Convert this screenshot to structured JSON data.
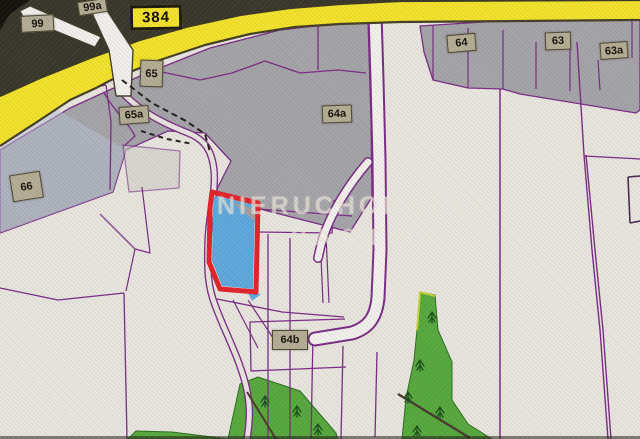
{
  "map": {
    "road_number": "384",
    "watermark": {
      "line1": "NIERUCHOMOŚCI",
      "line2": "PASTWA"
    },
    "highlight": {
      "fill_color": "#5fa8dc",
      "outline_color": "#e3242b"
    },
    "palette": {
      "background": "#e9e6df",
      "built_gray": "#a5a4a9",
      "boundary_purple": "#7b2d85",
      "road_yellow": "#f3e32c",
      "forest_green": "#57a93e",
      "label_tan": "#b5ad95"
    },
    "labels": [
      {
        "text": "99",
        "kind": "parcel",
        "x": 21,
        "y": 15,
        "w": 33,
        "h": 17,
        "rot": -3
      },
      {
        "text": "99a",
        "kind": "parcel",
        "x": 78,
        "y": 0,
        "w": 29,
        "h": 14,
        "rot": -9
      },
      {
        "text": "384",
        "kind": "road",
        "x": 130,
        "y": 5,
        "w": 52,
        "h": 25,
        "rot": -1
      },
      {
        "text": "65",
        "kind": "parcel",
        "x": 140,
        "y": 60,
        "w": 23,
        "h": 27,
        "rot": 2
      },
      {
        "text": "65a",
        "kind": "parcel",
        "x": 119,
        "y": 106,
        "w": 30,
        "h": 18,
        "rot": -4
      },
      {
        "text": "66",
        "kind": "parcel",
        "x": 11,
        "y": 173,
        "w": 31,
        "h": 27,
        "rot": -9
      },
      {
        "text": "64",
        "kind": "parcel",
        "x": 447,
        "y": 34,
        "w": 29,
        "h": 18,
        "rot": -5
      },
      {
        "text": "63",
        "kind": "parcel",
        "x": 545,
        "y": 32,
        "w": 26,
        "h": 18,
        "rot": -2
      },
      {
        "text": "63a",
        "kind": "parcel",
        "x": 600,
        "y": 42,
        "w": 28,
        "h": 17,
        "rot": -4
      },
      {
        "text": "64a",
        "kind": "parcel",
        "x": 322,
        "y": 105,
        "w": 30,
        "h": 18,
        "rot": -2
      },
      {
        "text": "64b",
        "kind": "parcel",
        "x": 272,
        "y": 330,
        "w": 36,
        "h": 20,
        "rot": 0
      }
    ],
    "geometry": {
      "trees": [
        [
          265,
          402
        ],
        [
          297,
          412
        ],
        [
          318,
          430
        ],
        [
          408,
          398
        ],
        [
          417,
          432
        ],
        [
          432,
          318
        ],
        [
          420,
          366
        ],
        [
          440,
          413
        ]
      ],
      "layers": [
        {
          "kind": "rect",
          "name": "map-background",
          "x": 0,
          "y": 0,
          "w": 640,
          "h": 439,
          "fill": "#e9e6df"
        },
        {
          "kind": "polygon",
          "name": "photo-dark-top-band",
          "points": "0,0 640,0 640,2 400,3 300,9 240,17 190,28 140,42 90,60 40,80 0,98",
          "fill": "#3a382b"
        },
        {
          "kind": "polygon",
          "name": "photo-dark-corner",
          "points": "0,0 30,0 10,14 0,30",
          "fill": "#15130d"
        },
        {
          "kind": "polygon",
          "name": "gray-region-main",
          "points": "0,150 70,108 140,76 210,48 280,30 368,20 371,120 372,197 350,232 213,197 231,161 205,133 168,131 126,150 113,192 0,233",
          "fill": "#a5a4a9",
          "stroke": "#7b2d85",
          "sw": 1.3
        },
        {
          "kind": "polygon",
          "name": "gray-region-66-tint",
          "points": "0,122 55,108 126,150 113,192 0,233",
          "fill": "#b7c1d4",
          "opacity": 0.5
        },
        {
          "kind": "polygon",
          "name": "gray-region-topright",
          "points": "420,26 640,12 640,110 636,113 520,94 503,89 468,88 433,80 424,52",
          "fill": "#a5a4a9",
          "stroke": "#7b2d85",
          "sw": 1.3
        },
        {
          "kind": "polygon",
          "name": "parcel-rect-65a-east",
          "points": "123,145 180,151 179,188 129,192",
          "fill": "#cfccc6",
          "opacity": 0.6,
          "stroke": "#7b2d85",
          "sw": 1.3
        },
        {
          "kind": "polygon",
          "name": "forest-bottom-center",
          "points": "228,439 240,384 258,377 300,391 336,433 338,439",
          "fill": "#57a93e",
          "stroke": "#2f6d22",
          "sw": 1
        },
        {
          "kind": "polygon",
          "name": "forest-right",
          "points": "420,292 435,295 438,330 452,362 452,400 468,424 492,439 402,439 406,398 414,360 417,330",
          "fill": "#57a93e",
          "stroke": "#2f6d22",
          "sw": 1
        },
        {
          "kind": "polygon",
          "name": "forest-bottom-left",
          "points": "128,439 136,431 172,432 228,439",
          "fill": "#57a93e",
          "stroke": "#2f6d22",
          "sw": 1
        },
        {
          "kind": "polyline",
          "name": "forest-edge-highlight",
          "points": "417,330 420,292 435,296",
          "stroke": "#c8d23c",
          "sw": 2
        },
        {
          "kind": "polyline",
          "name": "boundary-left-diag",
          "points": "0,107 60,94 106,85",
          "stroke": "#7b2d85",
          "sw": 1.3
        },
        {
          "kind": "polyline",
          "name": "boundary-left-vert",
          "points": "106,85 111,122 110,190",
          "stroke": "#7b2d85",
          "sw": 1.3
        },
        {
          "kind": "polyline",
          "name": "boundary-zigzag-under-road",
          "points": "131,55 162,72 200,80 232,73 265,61 300,73 338,70 366,73",
          "stroke": "#7b2d85",
          "sw": 1.3
        },
        {
          "kind": "polyline",
          "name": "boundary-vert-318",
          "points": "318,22 318,70",
          "stroke": "#7b2d85",
          "sw": 1.3
        },
        {
          "kind": "path",
          "name": "boundary-curve-65a",
          "d": "M104,93 C115,112 130,125 135,136 L124,146",
          "stroke": "#7b2d85",
          "sw": 1.3
        },
        {
          "kind": "polyline",
          "name": "boundary-watermark-h1",
          "points": "258,209 352,216",
          "stroke": "#7b2d85",
          "sw": 1.3
        },
        {
          "kind": "polyline",
          "name": "boundary-watermark-h2",
          "points": "258,232 332,233 334,200",
          "stroke": "#7b2d85",
          "sw": 1.3
        },
        {
          "kind": "polyline",
          "name": "boundary-apex-twin1",
          "points": "320,234 323,303",
          "stroke": "#7b2d85",
          "sw": 1.2
        },
        {
          "kind": "polyline",
          "name": "boundary-apex-twin2",
          "points": "326,234 329,303",
          "stroke": "#7b2d85",
          "sw": 1.2
        },
        {
          "kind": "polyline",
          "name": "boundary-vert-268",
          "points": "268,234 268,439",
          "stroke": "#7b2d85",
          "sw": 1.3
        },
        {
          "kind": "polyline",
          "name": "boundary-vert-290",
          "points": "290,238 290,439",
          "stroke": "#7b2d85",
          "sw": 1.3
        },
        {
          "kind": "polyline",
          "name": "boundary-vert-313",
          "points": "313,335 311,439",
          "stroke": "#7b2d85",
          "sw": 1.3
        },
        {
          "kind": "polyline",
          "name": "boundary-vert-343",
          "points": "343,346 341,439",
          "stroke": "#7b2d85",
          "sw": 1.3
        },
        {
          "kind": "polyline",
          "name": "boundary-vert-377",
          "points": "377,352 375,437",
          "stroke": "#7b2d85",
          "sw": 1.3
        },
        {
          "kind": "polyline",
          "name": "boundary-diag-a",
          "points": "233,300 258,348",
          "stroke": "#7b2d85",
          "sw": 1.2
        },
        {
          "kind": "polyline",
          "name": "boundary-diag-b",
          "points": "248,300 277,344",
          "stroke": "#7b2d85",
          "sw": 1.2
        },
        {
          "kind": "polyline",
          "name": "boundary-64b-top",
          "points": "217,299 282,312 344,317",
          "stroke": "#7b2d85",
          "sw": 1.3
        },
        {
          "kind": "polyline",
          "name": "boundary-64b-box",
          "points": "345,319 250,322 251,371 346,367",
          "stroke": "#7b2d85",
          "sw": 1.3
        },
        {
          "kind": "polyline",
          "name": "boundary-bl-horiz",
          "points": "0,288 58,300 124,293",
          "stroke": "#7b2d85",
          "sw": 1.3
        },
        {
          "kind": "polyline",
          "name": "boundary-bl-vert",
          "points": "124,293 127,439",
          "stroke": "#7b2d85",
          "sw": 1.3
        },
        {
          "kind": "polyline",
          "name": "boundary-channel-1",
          "points": "100,214 135,249 126,291",
          "stroke": "#7b2d85",
          "sw": 1.2
        },
        {
          "kind": "polyline",
          "name": "boundary-channel-2",
          "points": "142,187 150,253 135,249",
          "stroke": "#7b2d85",
          "sw": 1.2
        },
        {
          "kind": "polyline",
          "name": "boundary-vert-500",
          "points": "500,89 500,439",
          "stroke": "#7b2d85",
          "sw": 1.5
        },
        {
          "kind": "polyline",
          "name": "boundary-double-right-1",
          "points": "577,42 584,155 592,250 600,330 608,439",
          "stroke": "#7b2d85",
          "sw": 1.4
        },
        {
          "kind": "polyline",
          "name": "boundary-double-right-2",
          "points": "586,155 595,250 603,330 611,439",
          "stroke": "#7b2d85",
          "sw": 1.4
        },
        {
          "kind": "polyline",
          "name": "boundary-right-h",
          "points": "584,156 640,159",
          "stroke": "#7b2d85",
          "sw": 1.3
        },
        {
          "kind": "polyline",
          "name": "boundary-redge-1",
          "points": "628,177 630,223",
          "stroke": "#4a2a50",
          "sw": 1.6
        },
        {
          "kind": "polyline",
          "name": "boundary-redge-2",
          "points": "628,177 640,176",
          "stroke": "#4a2a50",
          "sw": 1.6
        },
        {
          "kind": "polyline",
          "name": "boundary-redge-3",
          "points": "630,223 640,221",
          "stroke": "#4a2a50",
          "sw": 1.6
        },
        {
          "kind": "polyline",
          "name": "boundary-g2-v1",
          "points": "433,25 433,80",
          "stroke": "#7b2d85",
          "sw": 1.2
        },
        {
          "kind": "polyline",
          "name": "boundary-g2-v2",
          "points": "468,28 468,88",
          "stroke": "#7b2d85",
          "sw": 1.2
        },
        {
          "kind": "polyline",
          "name": "boundary-g2-v3",
          "points": "503,30 503,89",
          "stroke": "#7b2d85",
          "sw": 1.2
        },
        {
          "kind": "polyline",
          "name": "boundary-g2-v4",
          "points": "536,42 536,89",
          "stroke": "#7b2d85",
          "sw": 1.2
        },
        {
          "kind": "polyline",
          "name": "boundary-g2-v5",
          "points": "570,46 570,91",
          "stroke": "#7b2d85",
          "sw": 1.2
        },
        {
          "kind": "polyline",
          "name": "boundary-g2-v6",
          "points": "598,60 600,90",
          "stroke": "#7b2d85",
          "sw": 1.2
        },
        {
          "kind": "polyline",
          "name": "boundary-g2-v7",
          "points": "632,12 632,58",
          "stroke": "#7b2d85",
          "sw": 1.2
        },
        {
          "kind": "path",
          "name": "road-center-casing",
          "d": "M122,92 C140,112 165,124 188,133 C206,140 212,152 214,170 C216,192 209,212 208,242 C207,270 208,287 215,305 C224,330 237,353 245,382 C251,404 250,420 247,439",
          "stroke": "#7b2d85",
          "sw": 7.5
        },
        {
          "kind": "path",
          "name": "road-center-fill",
          "d": "M122,92 C140,112 165,124 188,133 C206,140 212,152 214,170 C216,192 209,212 208,242 C207,270 208,287 215,305 C224,330 237,353 245,382 C251,404 250,420 247,439",
          "stroke": "#e9e6df",
          "sw": 4.8
        },
        {
          "kind": "path",
          "name": "road-white-vertical-casing",
          "d": "M375,13 L377,80 L379,160 L380,250 L378,298 C376,318 368,328 352,333 L315,339",
          "stroke": "#7b2d85",
          "sw": 15,
          "linecap": "round"
        },
        {
          "kind": "path",
          "name": "road-white-vertical-fill",
          "d": "M375,13 L377,80 L379,160 L380,250 L378,298 C376,318 368,328 352,333 L315,339",
          "stroke": "#f3f1ec",
          "sw": 11,
          "linecap": "round"
        },
        {
          "kind": "path",
          "name": "road-white-branch-casing",
          "d": "M368,162 C350,183 329,214 321,245 L318,258",
          "stroke": "#7b2d85",
          "sw": 10,
          "linecap": "round"
        },
        {
          "kind": "path",
          "name": "road-white-branch-fill",
          "d": "M368,162 C350,183 329,214 321,245 L318,258",
          "stroke": "#f3f1ec",
          "sw": 7,
          "linecap": "round"
        },
        {
          "kind": "polygon",
          "name": "road-yellow-384",
          "points": "0,96 40,78 90,58 140,40 190,26 240,15 290,8 340,4 400,1 640,0 640,20 400,22 340,24 295,27 250,34 205,45 160,60 115,78 96,88 70,100 40,120 0,146",
          "fill": "#f3e32c"
        },
        {
          "kind": "polyline",
          "name": "road-yellow-top-edge",
          "points": "0,96 40,78 90,58 140,40 190,26 240,15 290,8 340,4 400,1 640,0",
          "stroke": "#3c3826",
          "sw": 2.2
        },
        {
          "kind": "polyline",
          "name": "road-yellow-bottom-edge",
          "points": "640,20 400,22 340,24 295,27 250,34 205,45 160,60 115,78 96,88 70,100 40,120 0,146",
          "stroke": "#463f28",
          "sw": 2.2
        },
        {
          "kind": "polygon",
          "name": "road-white-topleft-upper",
          "points": "20,11 30,6 101,37 95,47 24,18",
          "fill": "#f3f1ec",
          "stroke": "#45402e",
          "sw": 1.2
        },
        {
          "kind": "polygon",
          "name": "road-white-topleft-diag",
          "points": "86,0 100,0 133,50 131,96 116,96 109,50",
          "fill": "#f3f1ec",
          "stroke": "#45402e",
          "sw": 1.4
        },
        {
          "kind": "polyline",
          "name": "footpath-dashed",
          "points": "122,80 152,103 186,121 205,134 210,152",
          "stroke": "#26231c",
          "sw": 2,
          "dash": "6,4"
        },
        {
          "kind": "polyline",
          "name": "footpath-dashed-spur",
          "points": "141,131 167,139 193,144",
          "stroke": "#26231c",
          "sw": 2,
          "dash": "5,4"
        },
        {
          "kind": "polygon",
          "name": "highlight-parcel-fill",
          "points": "214,196 255,205 253,289 222,286 212,261 213,208",
          "fill": "#5fa8dc",
          "interactable": true
        },
        {
          "kind": "polygon",
          "name": "highlight-parcel-gray-corner",
          "points": "233,203 256,209 256,223",
          "fill": "#9fa0a6"
        },
        {
          "kind": "polygon",
          "name": "highlight-parcel-blue-sliver",
          "points": "247,291 261,294 252,301",
          "fill": "#5fa8dc"
        },
        {
          "kind": "polygon",
          "name": "highlight-parcel-outline",
          "points": "212,192 258,203 256,292 220,289 209,262 210,208",
          "fill": "none",
          "stroke": "#e3242b",
          "sw": 5,
          "interactable": true
        },
        {
          "kind": "polyline",
          "name": "forest-dark-line-right",
          "points": "398,394 470,438",
          "stroke": "#4c3a32",
          "sw": 2.4
        },
        {
          "kind": "polyline",
          "name": "forest-dark-line-center",
          "points": "247,392 276,439",
          "stroke": "#4c3a32",
          "sw": 2
        },
        {
          "kind": "rect",
          "name": "photo-dark-bottom-edge",
          "x": 0,
          "y": 436,
          "w": 640,
          "h": 3,
          "fill": "#23211a",
          "opacity": 0.55
        }
      ]
    }
  }
}
